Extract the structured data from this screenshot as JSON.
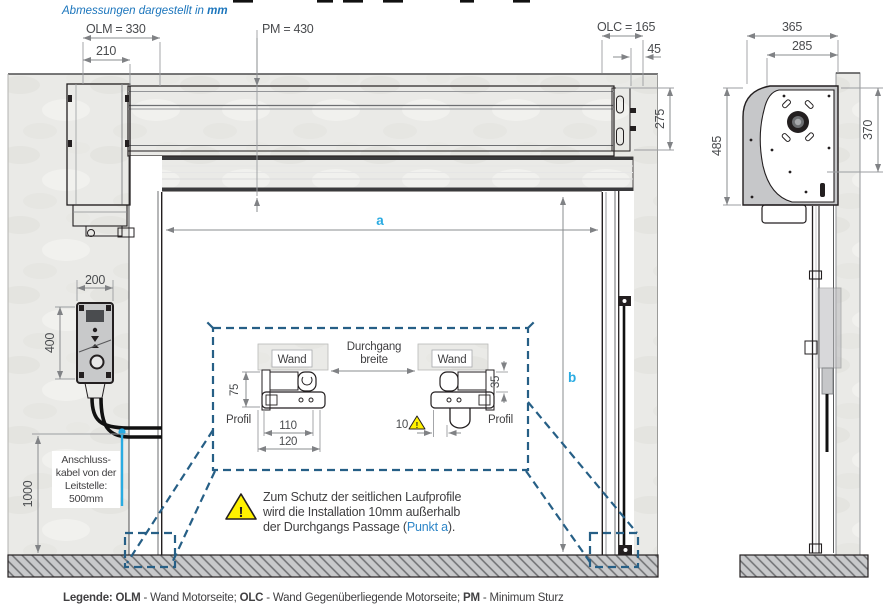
{
  "header": {
    "note_italic": "Abmessungen dargestellt in ",
    "note_bold": "mm"
  },
  "dims": {
    "olm": "OLM = 330",
    "w210": "210",
    "pm": "PM = 430",
    "olc": "OLC = 165",
    "w45": "45",
    "h275": "275",
    "a": "a",
    "b": "b",
    "w200": "200",
    "h400": "400",
    "h1000": "1000",
    "sv_w365": "365",
    "sv_w285": "285",
    "sv_h485": "485",
    "sv_h370": "370"
  },
  "cable_note": {
    "line1": "Anschluss-",
    "line2": "kabel von der",
    "line3": "Leitstelle:",
    "line4": "500mm"
  },
  "detail": {
    "wand_left": "Wand",
    "wand_right": "Wand",
    "durchgang_line1": "Durchgang",
    "durchgang_line2": "breite",
    "d75": "75",
    "d110": "110",
    "d120": "120",
    "d35": "35",
    "d10": "10",
    "profil_left": "Profil",
    "profil_right": "Profil"
  },
  "warning": {
    "bang": "!",
    "line1": "Zum Schutz der seitlichen Laufprofile",
    "line2": "wird die Installation 10mm außerhalb",
    "line3_pre": "der Durchgangs Passage (",
    "line3_link": "Punkt a",
    "line3_post": ")."
  },
  "legend": {
    "label": "Legende: ",
    "k1": "OLM",
    "v1": " - Wand Motorseite; ",
    "k2": "OLC",
    "v2": " - Wand Gegenüberliegende Motorseite; ",
    "k3": "PM",
    "v3": " - Minimum Sturz"
  },
  "colors": {
    "accent_blue": "#29abe2",
    "header_blue": "#1b75bc",
    "callout_blue": "#265f86",
    "warning_yellow": "#fff200",
    "dim_gray": "#8a8c8f",
    "ink": "#231f20"
  }
}
